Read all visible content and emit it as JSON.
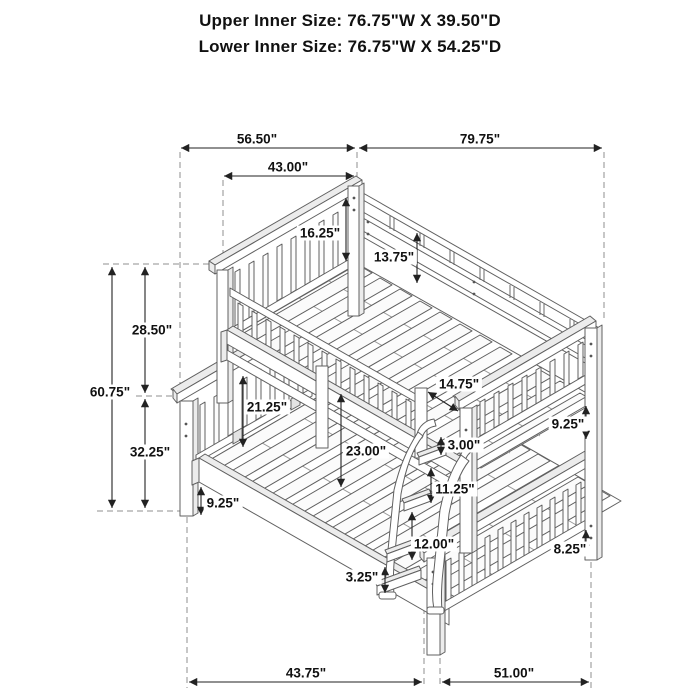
{
  "title": {
    "upper_line": "Upper Inner Size: 76.75\"W X 39.50\"D",
    "lower_line": "Lower Inner Size: 76.75\"W X 54.25\"D"
  },
  "dimensions": {
    "top_left_span": "56.50\"",
    "top_right_span": "79.75\"",
    "upper_bed_width": "43.00\"",
    "upper_guardrail_height": "16.25\"",
    "upper_headboard_inner": "13.75\"",
    "upper_section_height": "28.50\"",
    "overall_height": "60.75\"",
    "lower_section_height": "32.25\"",
    "rail_to_lower_deck": "21.25\"",
    "ladder_to_footboard": "14.75\"",
    "bunk_clearance": "23.00\"",
    "ladder_top_gap": "3.00\"",
    "upper_foot_rail_gap": "9.25\"",
    "rung_spacing_upper": "11.25\"",
    "rung_spacing_lower": "12.00\"",
    "ladder_foot_height": "3.25\"",
    "lower_rail_clearance": "9.25\"",
    "lower_foot_rail_gap": "8.25\"",
    "floor_left_span": "43.75\"",
    "floor_right_span": "51.00\""
  }
}
